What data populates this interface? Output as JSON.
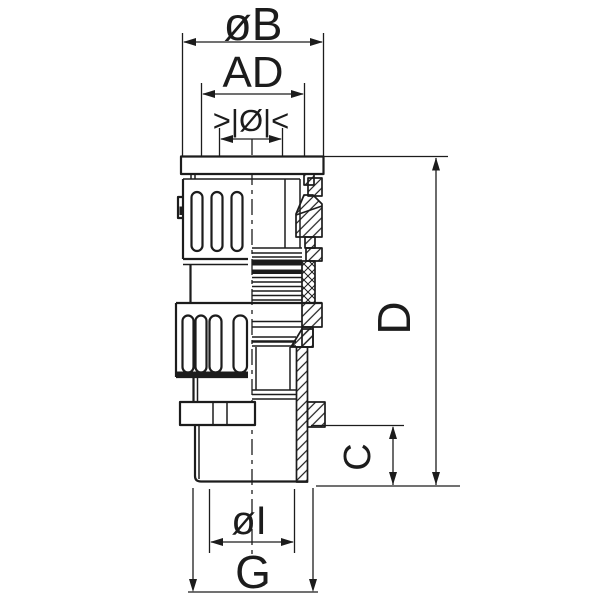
{
  "drawing": {
    "type": "technical-section-drawing",
    "background_color": "#ffffff",
    "line_color": "#1c1c1c",
    "labels": {
      "cap_diameter": "øB",
      "outer_diameter": "AD",
      "clamping_range": ">|Ø|<",
      "overall_length": "D",
      "connection_length": "C",
      "inner_diameter": "øI",
      "thread": "G"
    }
  }
}
